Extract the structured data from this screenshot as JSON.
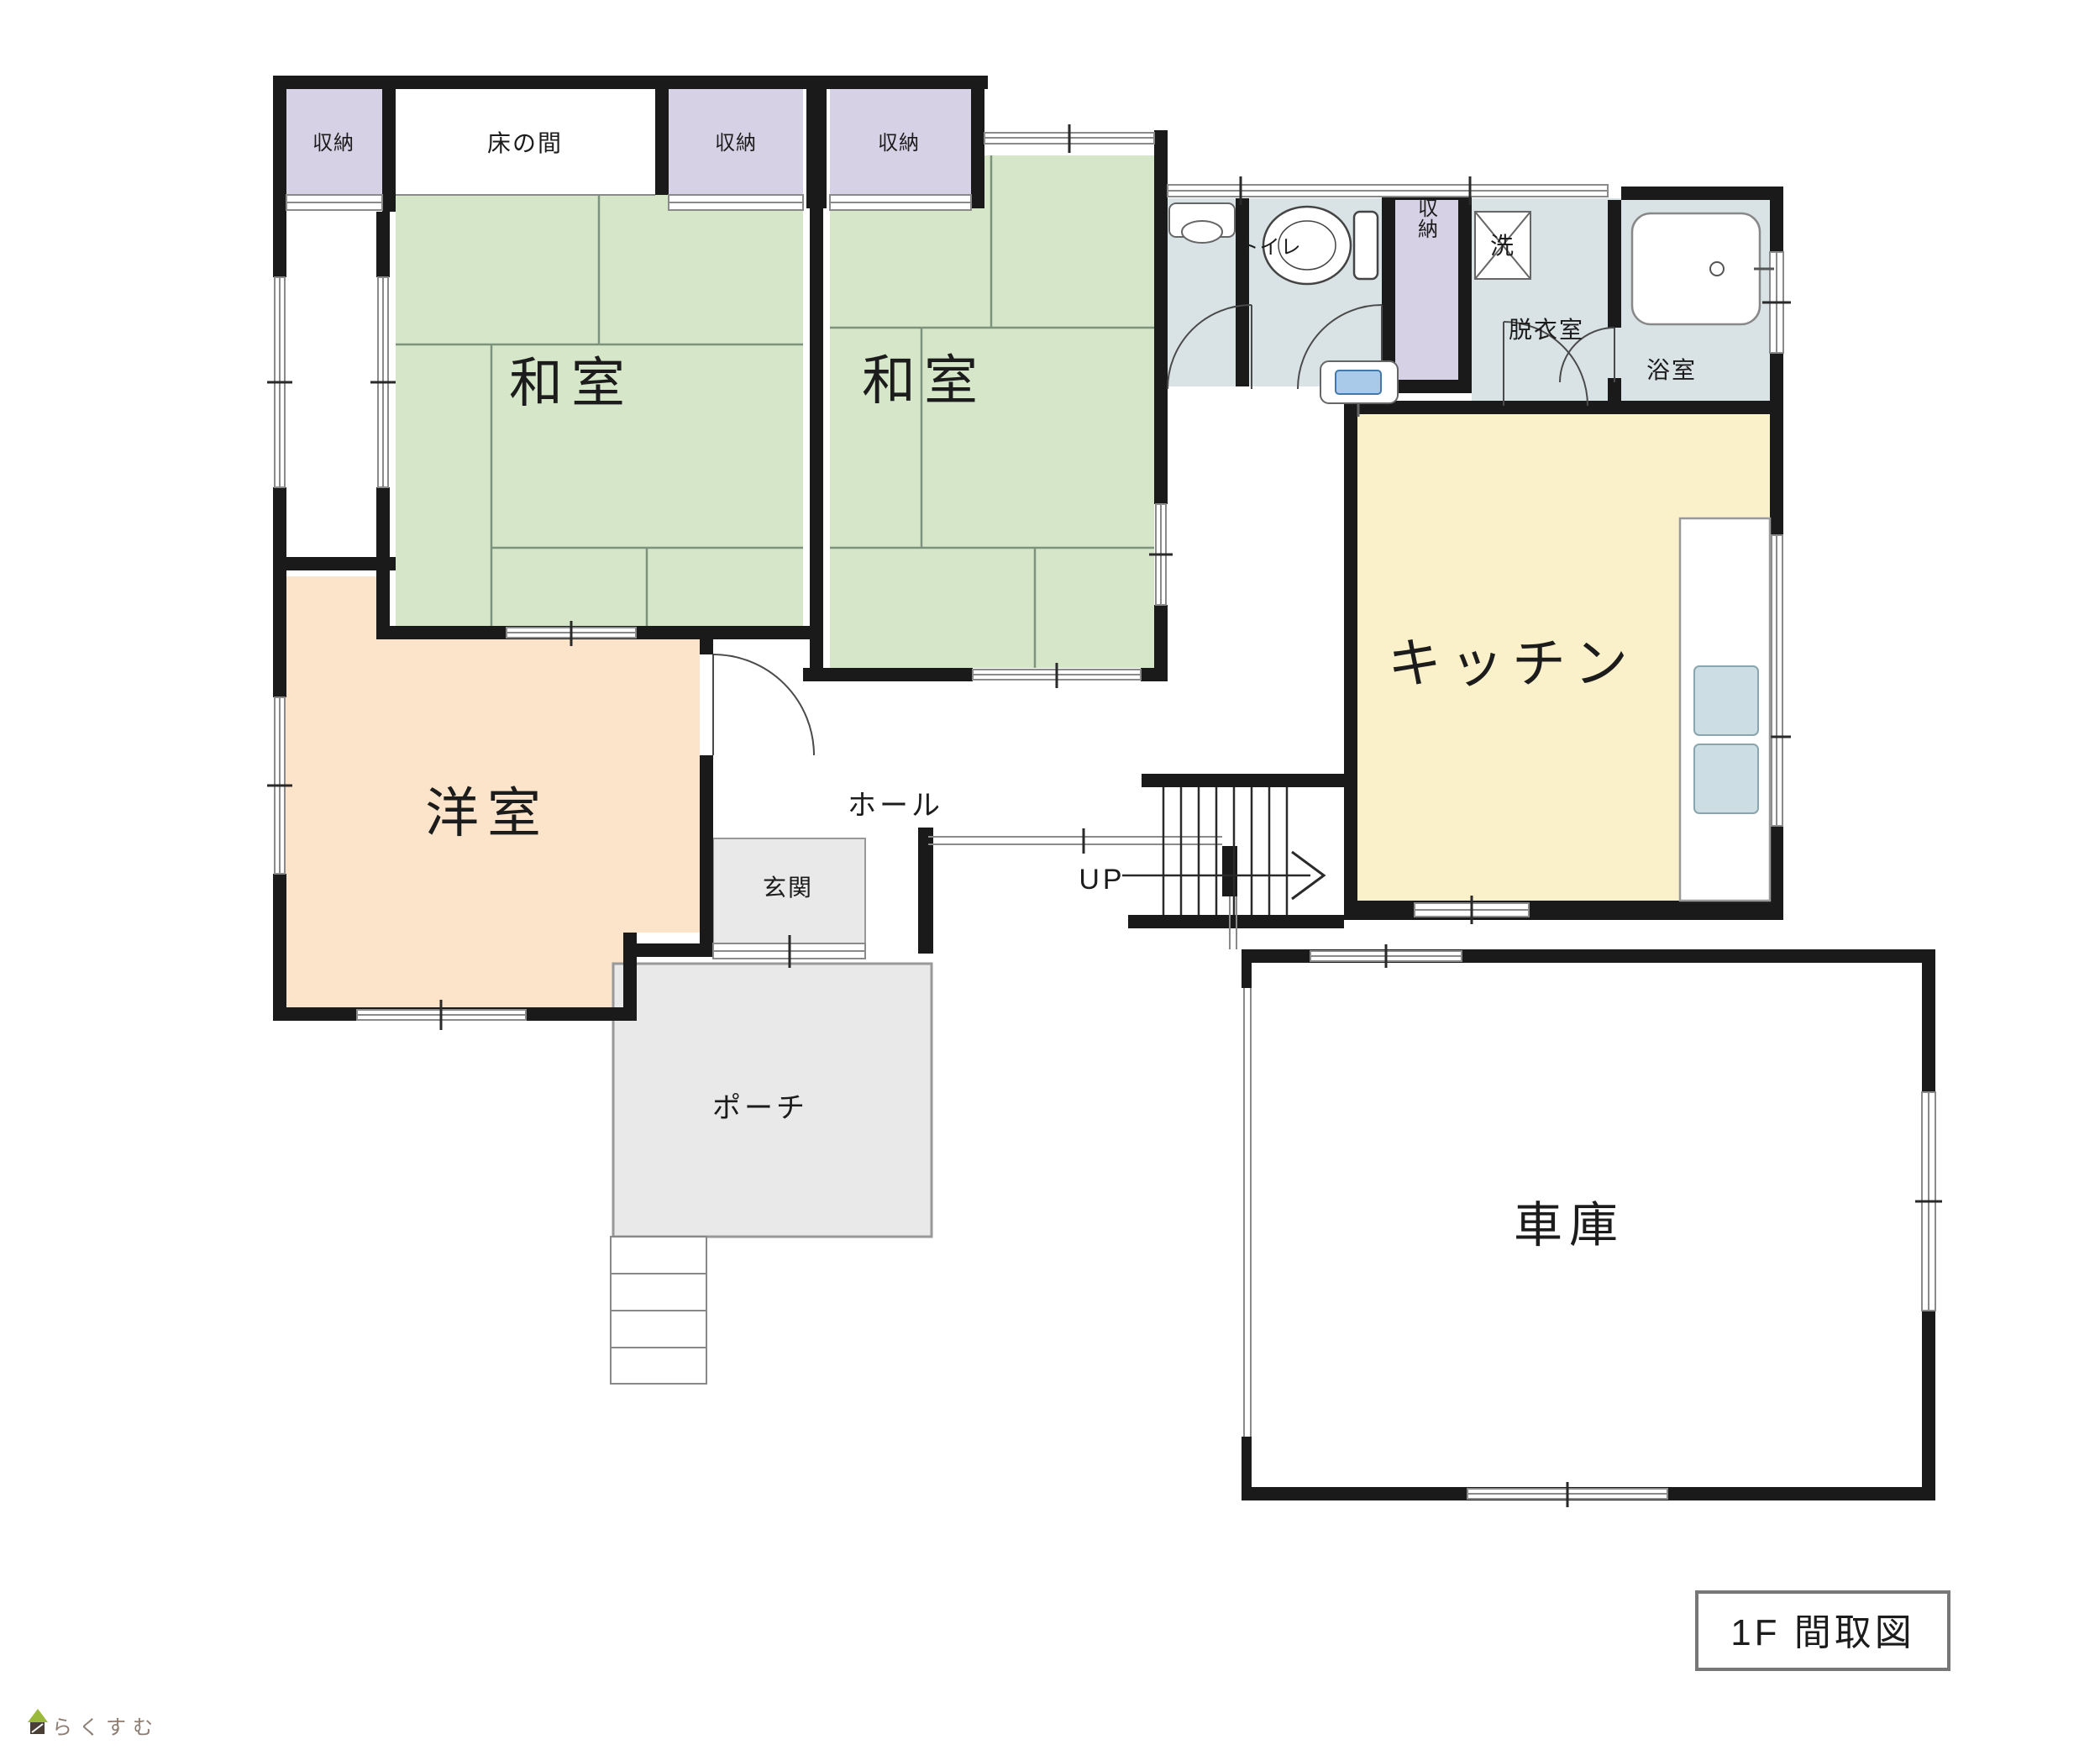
{
  "floorplan": {
    "title": "1F 間取図",
    "watermark": "らくすむ",
    "rooms": {
      "closet": "収納",
      "tokonoma": "床の間",
      "washitsu": "和室",
      "youshitsu": "洋室",
      "kitchen": "キッチン",
      "hall": "ホール",
      "genkan": "玄関",
      "porch": "ポーチ",
      "garage": "車庫",
      "toilet": "トイレ",
      "dressing_room": "脱衣室",
      "bathroom": "浴室"
    },
    "fixtures": {
      "laundry": "洗",
      "stairs_up": "UP"
    },
    "icon_names": [
      "toilet-icon",
      "bathtub-icon",
      "washbasin-icon",
      "corner-sink-icon",
      "washing-machine-icon",
      "stairs-up-arrow-icon",
      "house-logo-icon"
    ],
    "colors": {
      "wall": "#1a1a1a",
      "tatami": "#d5e6c9",
      "tatami_line": "#7e937e",
      "closet": "#d7d1e5",
      "water": "#d9e3e5",
      "kitchen": "#faf0c9",
      "western": "#fbe4c9",
      "entry": "#e9e9e9",
      "fixture_blue": "#a9cbe9",
      "counter": "#ccdde3"
    }
  }
}
